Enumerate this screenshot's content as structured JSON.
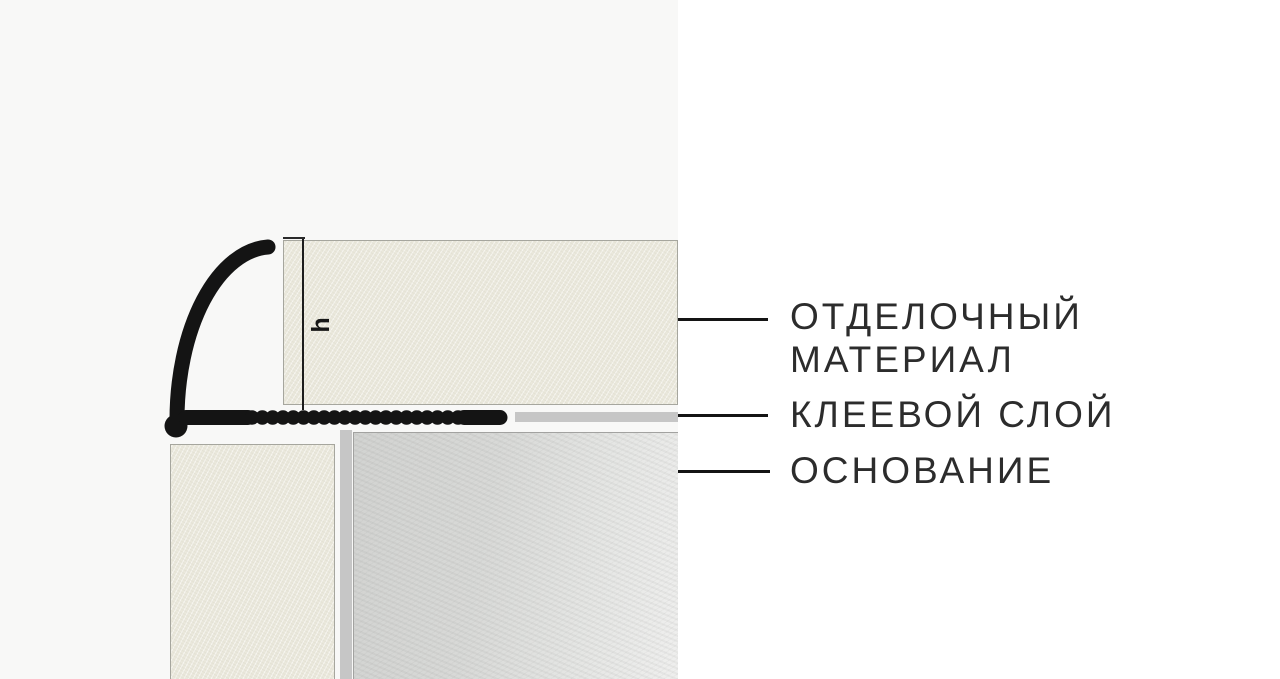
{
  "diagram": {
    "dimension": {
      "label": "h"
    },
    "callouts": {
      "finishing_material": {
        "line1": "ОТДЕЛОЧНЫЙ",
        "line2": "МАТЕРИАЛ"
      },
      "adhesive_layer": {
        "line1": "КЛЕЕВОЙ СЛОЙ"
      },
      "substrate": {
        "line1": "ОСНОВАНИЕ"
      }
    },
    "colors": {
      "page_bg": "#ffffff",
      "panel_bg": "#f8f8f7",
      "profile_black": "#141414",
      "tile_fill": "#eae8dc",
      "tile_border": "#a6a69e",
      "adhesive_gray": "#c6c6c6",
      "substrate_fill": "#d6d7d5",
      "substrate_fade": "#efefee",
      "substrate_border": "#a2a2a0",
      "callout_line": "#141414",
      "text": "#2c2c2c"
    }
  }
}
